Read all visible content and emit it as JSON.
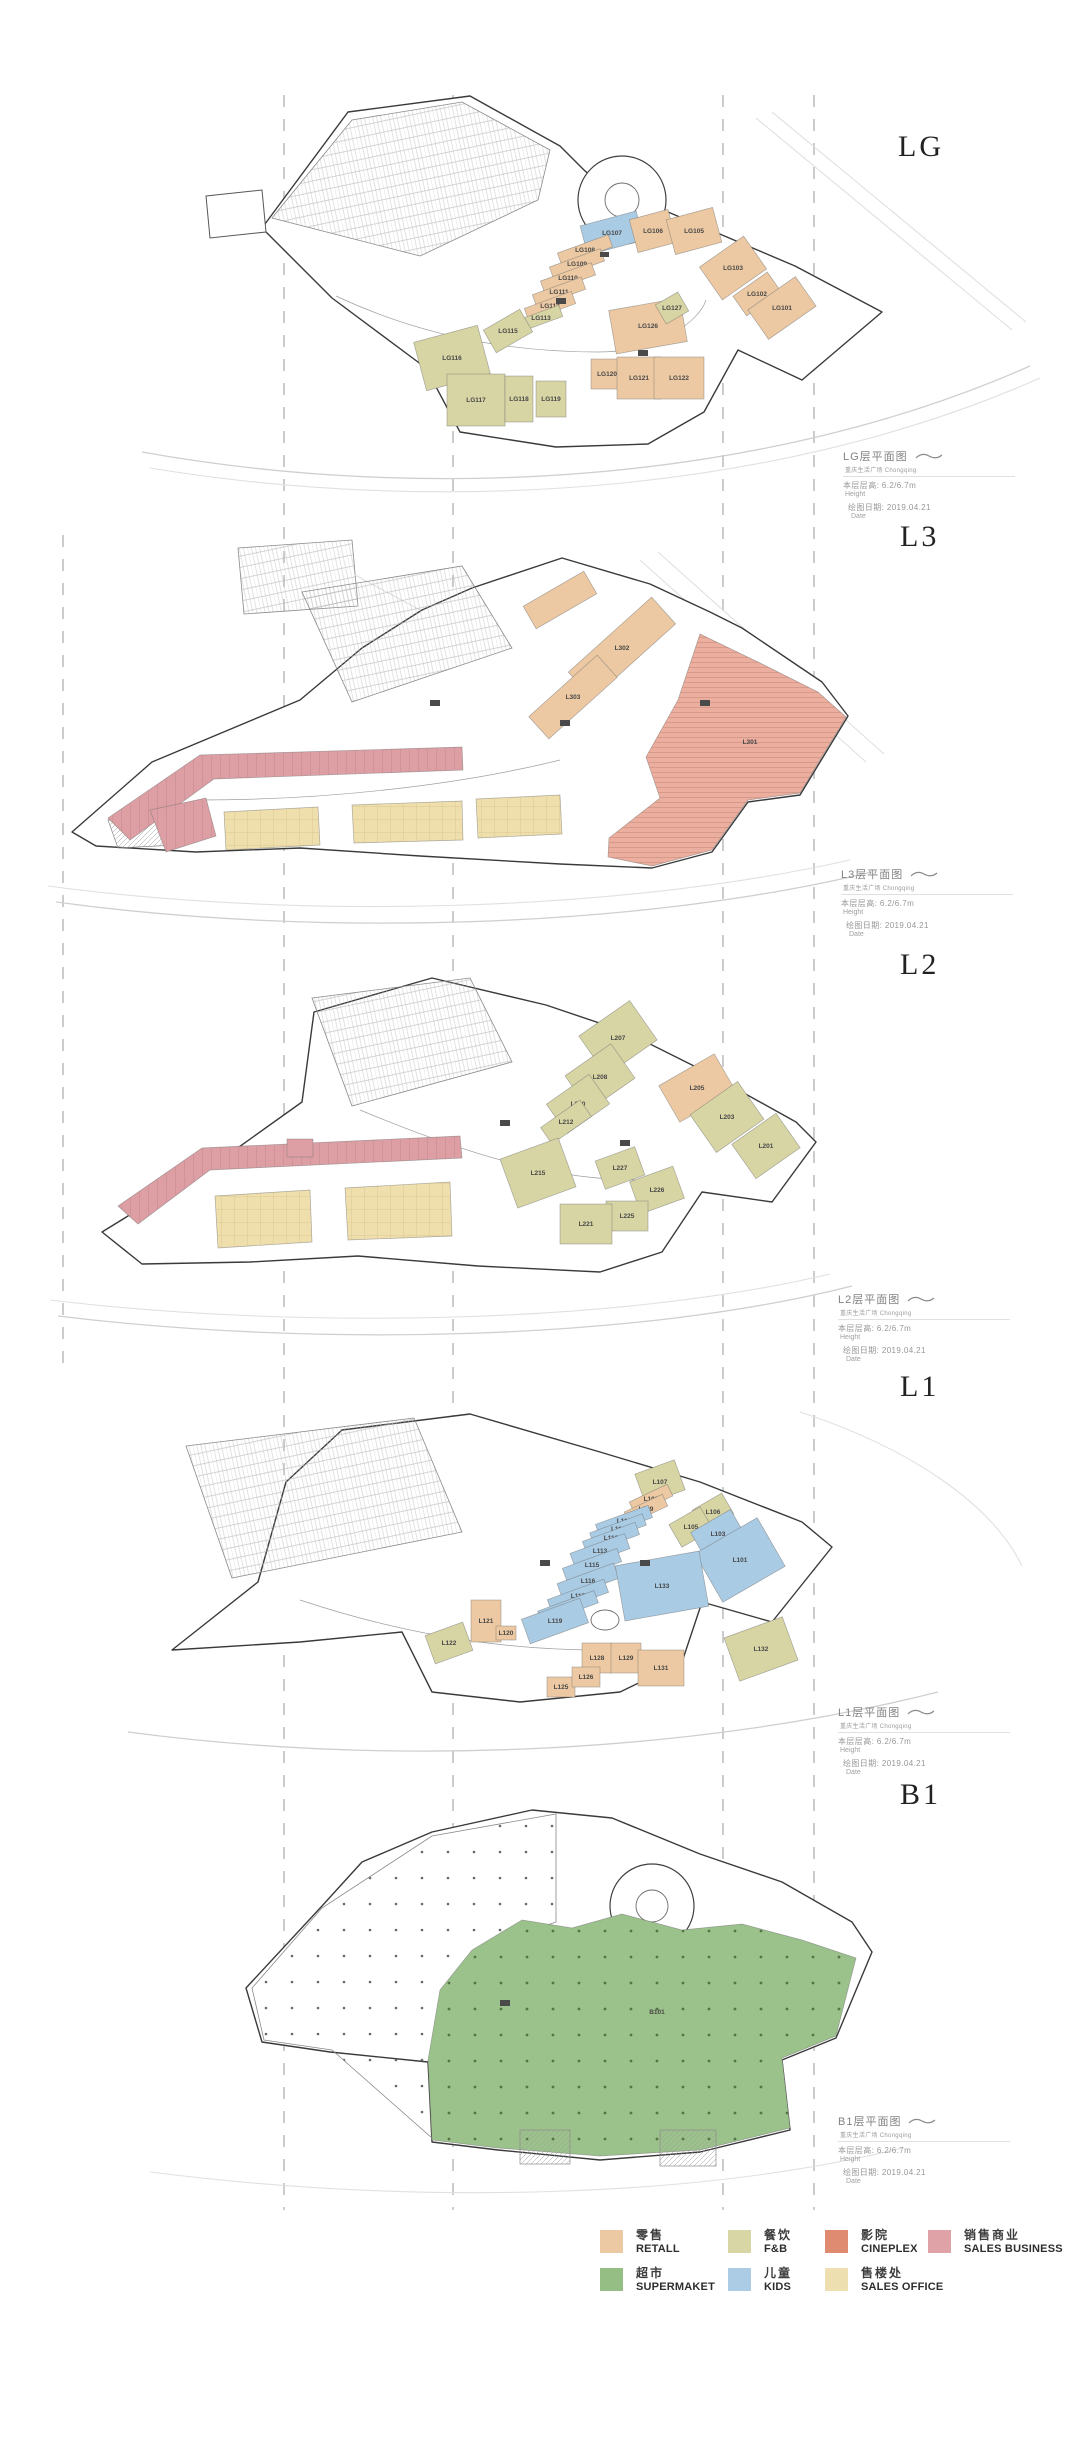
{
  "category_colors": {
    "retail": "#ECC9A2",
    "fnb": "#D8D5A4",
    "cineplex": "#ECAE9E",
    "sales_business": "#DE9FA4",
    "supermarket": "#9CC28C",
    "kids": "#A9CBE4",
    "sales_office": "#EFDFAC"
  },
  "legend": {
    "items": [
      {
        "cn": "零售",
        "en": "RETALL",
        "color": "#EDC9A3"
      },
      {
        "cn": "餐饮",
        "en": "F&B",
        "color": "#D9D6A6"
      },
      {
        "cn": "影院",
        "en": "CINEPLEX",
        "color": "#DE8B71"
      },
      {
        "cn": "销售商业",
        "en": "SALES BUSINESS",
        "color": "#DFA2A6"
      },
      {
        "cn": "超市",
        "en": "SUPERMAKET",
        "color": "#95BE84"
      },
      {
        "cn": "儿童",
        "en": "KIDS",
        "color": "#ABCCE4"
      },
      {
        "cn": "售楼处",
        "en": "SALES OFFICE",
        "color": "#EDDFAF"
      }
    ]
  },
  "floors": [
    {
      "title": "LG",
      "annotation": {
        "title": "LG层平面图",
        "subtitle": "重庆生活广场 Chongqing",
        "height_label": "本层层高: 6.2/6.7m",
        "height_en": "Height",
        "date_label": "绘图日期: 2019.04.21",
        "date_en": "Date"
      },
      "units": [
        {
          "label": "LG107",
          "cat": "kids",
          "x": 612,
          "y": 233,
          "w": 58,
          "h": 30,
          "r": -15
        },
        {
          "label": "LG106",
          "cat": "retail",
          "x": 653,
          "y": 231,
          "w": 40,
          "h": 34,
          "r": -15
        },
        {
          "label": "LG105",
          "cat": "retail",
          "x": 694,
          "y": 231,
          "w": 48,
          "h": 36,
          "r": -15
        },
        {
          "label": "LG103",
          "cat": "retail",
          "x": 733,
          "y": 268,
          "w": 54,
          "h": 40,
          "r": -35
        },
        {
          "label": "LG102",
          "cat": "retail",
          "x": 757,
          "y": 294,
          "w": 42,
          "h": 24,
          "r": -35
        },
        {
          "label": "LG101",
          "cat": "retail",
          "x": 782,
          "y": 308,
          "w": 58,
          "h": 36,
          "r": -35
        },
        {
          "label": "LG108",
          "cat": "retail",
          "x": 585,
          "y": 250,
          "w": 54,
          "h": 13,
          "r": -20
        },
        {
          "label": "LG109",
          "cat": "retail",
          "x": 577,
          "y": 264,
          "w": 54,
          "h": 13,
          "r": -20
        },
        {
          "label": "LG110",
          "cat": "retail",
          "x": 568,
          "y": 278,
          "w": 54,
          "h": 13,
          "r": -20
        },
        {
          "label": "LG111",
          "cat": "retail",
          "x": 559,
          "y": 292,
          "w": 52,
          "h": 13,
          "r": -20
        },
        {
          "label": "LG112",
          "cat": "retail",
          "x": 550,
          "y": 306,
          "w": 50,
          "h": 13,
          "r": -20
        },
        {
          "label": "LG113",
          "cat": "fnb",
          "x": 541,
          "y": 318,
          "w": 42,
          "h": 12,
          "r": -20
        },
        {
          "label": "LG115",
          "cat": "fnb",
          "x": 508,
          "y": 331,
          "w": 42,
          "h": 26,
          "r": -30
        },
        {
          "label": "LG116",
          "cat": "fnb",
          "x": 452,
          "y": 358,
          "w": 66,
          "h": 50,
          "r": -15
        },
        {
          "label": "LG117",
          "cat": "fnb",
          "x": 476,
          "y": 400,
          "w": 58,
          "h": 52,
          "r": 0
        },
        {
          "label": "LG118",
          "cat": "fnb",
          "x": 519,
          "y": 399,
          "w": 28,
          "h": 46,
          "r": 0
        },
        {
          "label": "LG119",
          "cat": "fnb",
          "x": 551,
          "y": 399,
          "w": 30,
          "h": 36,
          "r": 0
        },
        {
          "label": "LG120",
          "cat": "retail",
          "x": 607,
          "y": 374,
          "w": 32,
          "h": 30,
          "r": 0
        },
        {
          "label": "LG121",
          "cat": "retail",
          "x": 639,
          "y": 378,
          "w": 44,
          "h": 42,
          "r": 0
        },
        {
          "label": "LG122",
          "cat": "retail",
          "x": 679,
          "y": 378,
          "w": 50,
          "h": 42,
          "r": 0
        },
        {
          "label": "LG126",
          "cat": "retail",
          "x": 648,
          "y": 326,
          "w": 72,
          "h": 44,
          "r": -10
        },
        {
          "label": "LG127",
          "cat": "fnb",
          "x": 672,
          "y": 308,
          "w": 26,
          "h": 22,
          "r": -30
        }
      ]
    },
    {
      "title": "L3",
      "annotation": {
        "title": "L3层平面图",
        "subtitle": "重庆生活广场 Chongqing",
        "height_label": "本层层高: 6.2/6.7m",
        "height_en": "Height",
        "date_label": "绘图日期: 2019.04.21",
        "date_en": "Date"
      },
      "units": [
        {
          "cat": "sales_business",
          "points": "108,818 200,755 462,747 463,770 214,779 130,840",
          "pattern": "pinkticks"
        },
        {
          "cat": "sales_business",
          "points": "150,810 206,798 216,836 166,852",
          "pattern": "pinkticks"
        },
        {
          "cat": "sales_office",
          "points": "224,812 318,807 320,845 226,850",
          "pattern": "yellowgrid"
        },
        {
          "cat": "sales_office",
          "points": "352,805 462,801 463,840 354,843",
          "pattern": "yellowgrid"
        },
        {
          "cat": "sales_office",
          "points": "476,799 560,795 562,834 478,838",
          "pattern": "yellowgrid"
        },
        {
          "label": "L301",
          "cat": "cineplex",
          "points": "700,634 762,664 818,692 846,717 800,793 748,800 712,850 652,866 608,857 609,838 660,798 646,757 678,700",
          "pattern": "cinelines",
          "lx": 750,
          "ly": 742,
          "ls": 7
        },
        {
          "label": "L302",
          "cat": "retail",
          "x": 622,
          "y": 648,
          "w": 112,
          "h": 36,
          "r": -42
        },
        {
          "label": "L303",
          "cat": "retail",
          "x": 573,
          "y": 697,
          "w": 92,
          "h": 30,
          "r": -42
        },
        {
          "cat": "retail",
          "x": 560,
          "y": 600,
          "w": 70,
          "h": 26,
          "r": -30
        }
      ]
    },
    {
      "title": "L2",
      "annotation": {
        "title": "L2层平面图",
        "subtitle": "重庆生活广场 Chongqing",
        "height_label": "本层层高: 6.2/6.7m",
        "height_en": "Height",
        "date_label": "绘图日期: 2019.04.21",
        "date_en": "Date"
      },
      "units": [
        {
          "cat": "sales_business",
          "points": "118,1206 202,1148 460,1136 462,1158 210,1170 138,1224",
          "pattern": "pinkticks"
        },
        {
          "cat": "sales_office",
          "points": "215,1196 310,1190 312,1242 218,1248",
          "pattern": "yellowgrid"
        },
        {
          "cat": "sales_office",
          "points": "345,1188 450,1182 452,1236 348,1240",
          "pattern": "yellowgrid"
        },
        {
          "cat": "sales_business",
          "x": 300,
          "y": 1148,
          "w": 26,
          "h": 18,
          "r": 0
        },
        {
          "label": "L207",
          "cat": "fnb",
          "x": 618,
          "y": 1038,
          "w": 62,
          "h": 48,
          "r": -35
        },
        {
          "label": "L208",
          "cat": "fnb",
          "x": 600,
          "y": 1077,
          "w": 56,
          "h": 42,
          "r": -35
        },
        {
          "label": "L210",
          "cat": "fnb",
          "x": 578,
          "y": 1104,
          "w": 52,
          "h": 36,
          "r": -35
        },
        {
          "label": "L212",
          "cat": "fnb",
          "x": 566,
          "y": 1122,
          "w": 48,
          "h": 20,
          "r": -35
        },
        {
          "label": "L215",
          "cat": "fnb",
          "x": 538,
          "y": 1173,
          "w": 62,
          "h": 52,
          "r": -20
        },
        {
          "label": "L205",
          "cat": "retail",
          "x": 697,
          "y": 1088,
          "w": 64,
          "h": 42,
          "r": -30
        },
        {
          "label": "L203",
          "cat": "fnb",
          "x": 727,
          "y": 1117,
          "w": 58,
          "h": 46,
          "r": -35
        },
        {
          "label": "L201",
          "cat": "fnb",
          "x": 766,
          "y": 1146,
          "w": 54,
          "h": 42,
          "r": -35
        },
        {
          "label": "L227",
          "cat": "fnb",
          "x": 620,
          "y": 1168,
          "w": 42,
          "h": 30,
          "r": -20
        },
        {
          "label": "L226",
          "cat": "fnb",
          "x": 657,
          "y": 1190,
          "w": 46,
          "h": 34,
          "r": -20
        },
        {
          "label": "L225",
          "cat": "fnb",
          "x": 627,
          "y": 1216,
          "w": 42,
          "h": 30,
          "r": 0
        },
        {
          "label": "L221",
          "cat": "fnb",
          "x": 586,
          "y": 1224,
          "w": 52,
          "h": 40,
          "r": 0
        }
      ]
    },
    {
      "title": "L1",
      "annotation": {
        "title": "L1层平面图",
        "subtitle": "重庆生活广场 Chongqing",
        "height_label": "本层层高: 6.2/6.7m",
        "height_en": "Height",
        "date_label": "绘图日期: 2019.04.21",
        "date_en": "Date"
      },
      "units": [
        {
          "label": "L107",
          "cat": "fnb",
          "x": 660,
          "y": 1482,
          "w": 42,
          "h": 32,
          "r": -20
        },
        {
          "label": "L108",
          "cat": "retail",
          "x": 651,
          "y": 1499,
          "w": 42,
          "h": 13,
          "r": -25
        },
        {
          "label": "L109",
          "cat": "retail",
          "x": 646,
          "y": 1509,
          "w": 42,
          "h": 13,
          "r": -25
        },
        {
          "label": "L106",
          "cat": "fnb",
          "x": 713,
          "y": 1512,
          "w": 34,
          "h": 24,
          "r": -30
        },
        {
          "label": "L105",
          "cat": "fnb",
          "x": 691,
          "y": 1527,
          "w": 36,
          "h": 26,
          "r": -30
        },
        {
          "label": "L103",
          "cat": "kids",
          "x": 718,
          "y": 1534,
          "w": 46,
          "h": 30,
          "r": -30
        },
        {
          "label": "L101",
          "cat": "kids",
          "x": 740,
          "y": 1560,
          "w": 72,
          "h": 56,
          "r": -30
        },
        {
          "label": "L110",
          "cat": "kids",
          "x": 624,
          "y": 1521,
          "w": 56,
          "h": 13,
          "r": -20
        },
        {
          "label": "L111",
          "cat": "kids",
          "x": 618,
          "y": 1529,
          "w": 56,
          "h": 12,
          "r": -20
        },
        {
          "label": "L112",
          "cat": "kids",
          "x": 611,
          "y": 1538,
          "w": 56,
          "h": 13,
          "r": -20
        },
        {
          "label": "L113",
          "cat": "kids",
          "x": 600,
          "y": 1551,
          "w": 58,
          "h": 16,
          "r": -20
        },
        {
          "label": "L115",
          "cat": "kids",
          "x": 592,
          "y": 1565,
          "w": 58,
          "h": 14,
          "r": -20
        },
        {
          "label": "L116",
          "cat": "kids",
          "x": 588,
          "y": 1581,
          "w": 60,
          "h": 16,
          "r": -20
        },
        {
          "label": "L117",
          "cat": "kids",
          "x": 578,
          "y": 1596,
          "w": 60,
          "h": 14,
          "r": -20
        },
        {
          "label": "L118",
          "cat": "kids",
          "x": 568,
          "y": 1607,
          "w": 60,
          "h": 13,
          "r": -20
        },
        {
          "label": "L119",
          "cat": "kids",
          "x": 555,
          "y": 1621,
          "w": 62,
          "h": 26,
          "r": -20
        },
        {
          "label": "L133",
          "cat": "kids",
          "x": 662,
          "y": 1586,
          "w": 85,
          "h": 56,
          "r": -10
        },
        {
          "label": "L121",
          "cat": "retail",
          "x": 486,
          "y": 1621,
          "w": 30,
          "h": 42,
          "r": 0
        },
        {
          "label": "L120",
          "cat": "retail",
          "x": 506,
          "y": 1633,
          "w": 20,
          "h": 14,
          "r": 0
        },
        {
          "label": "L122",
          "cat": "fnb",
          "x": 449,
          "y": 1643,
          "w": 40,
          "h": 30,
          "r": -20
        },
        {
          "label": "L128",
          "cat": "retail",
          "x": 597,
          "y": 1658,
          "w": 30,
          "h": 30,
          "r": 0
        },
        {
          "label": "L129",
          "cat": "retail",
          "x": 626,
          "y": 1658,
          "w": 30,
          "h": 30,
          "r": 0
        },
        {
          "label": "L131",
          "cat": "retail",
          "x": 661,
          "y": 1668,
          "w": 46,
          "h": 36,
          "r": 0
        },
        {
          "label": "L125",
          "cat": "retail",
          "x": 561,
          "y": 1687,
          "w": 28,
          "h": 20,
          "r": 0
        },
        {
          "label": "L126",
          "cat": "retail",
          "x": 586,
          "y": 1677,
          "w": 28,
          "h": 20,
          "r": 0
        },
        {
          "label": "L132",
          "cat": "fnb",
          "x": 761,
          "y": 1649,
          "w": 62,
          "h": 46,
          "r": -20
        }
      ]
    },
    {
      "title": "B1",
      "annotation": {
        "title": "B1层平面图",
        "subtitle": "重庆生活广场 Chongqing",
        "height_label": "本层层高: 6.2/6.7m",
        "height_en": "Height",
        "date_label": "绘图日期: 2019.04.21",
        "date_en": "Date"
      },
      "units": [
        {
          "label": "B101",
          "cat": "supermarket",
          "points": "440,1990 472,1950 522,1920 572,1928 622,1914 682,1930 742,1924 802,1940 856,1958 836,2036 782,2058 790,2128 700,2150 600,2156 498,2148 432,2140 428,2060",
          "pattern": "greendots",
          "lx": 657,
          "ly": 2012,
          "ls": 8
        }
      ]
    }
  ]
}
